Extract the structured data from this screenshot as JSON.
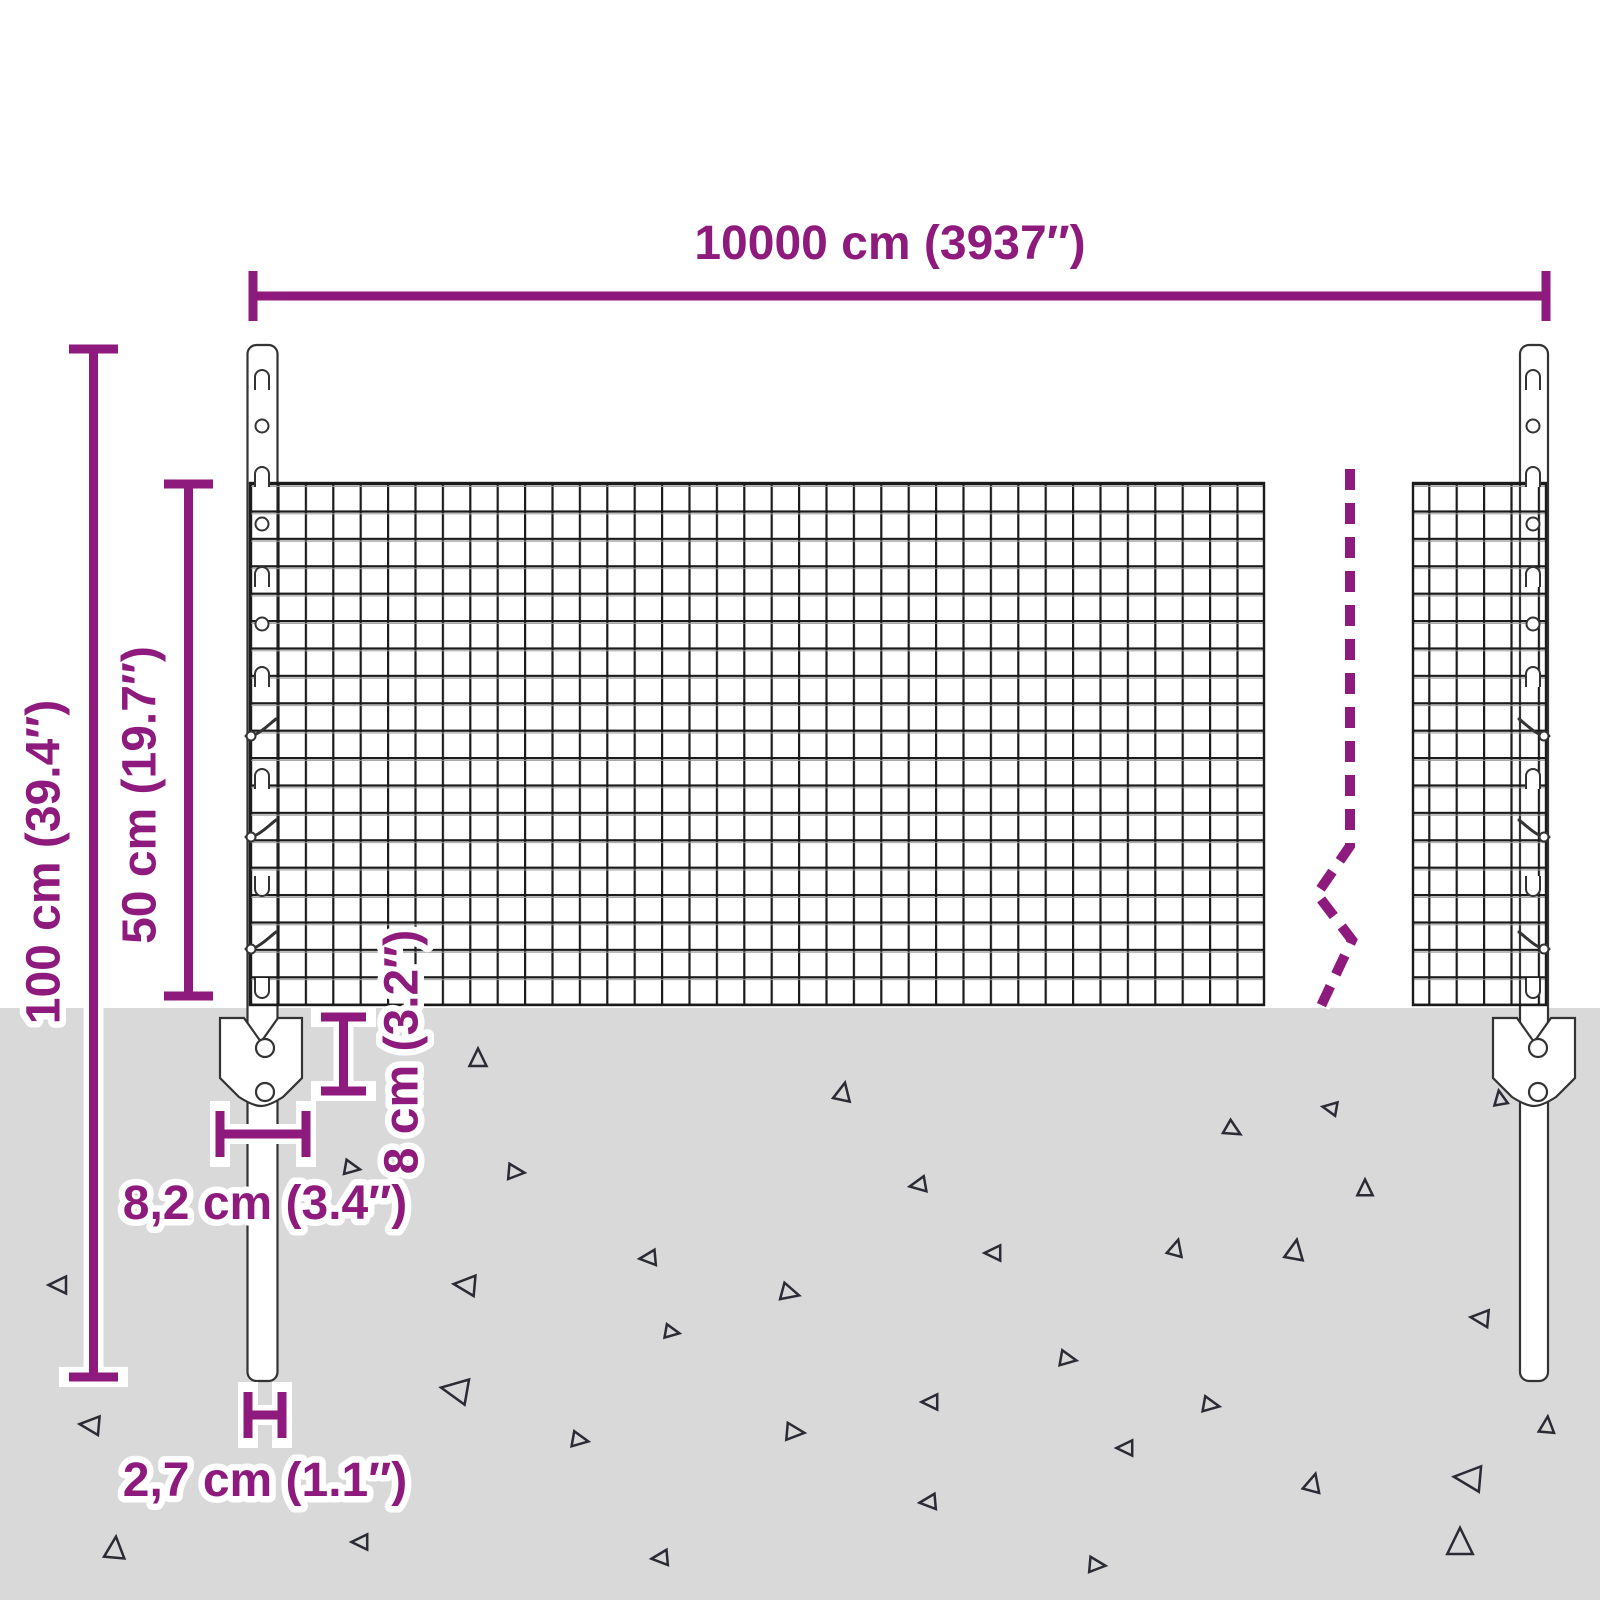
{
  "diagram": {
    "dimensions": {
      "total_width": {
        "label": "10000 cm (3937″)"
      },
      "post_height": {
        "label": "100 cm (39.4″)"
      },
      "mesh_height": {
        "label": "50 cm (19.7″)"
      },
      "anchor_depth": {
        "label": "8 cm (3.2″)"
      },
      "anchor_width": {
        "label": "8,2 cm (3.4″)"
      },
      "post_width": {
        "label": "2,7 cm (1.1″)"
      }
    },
    "colors": {
      "accent": "#8e1a7d",
      "ground": "#d9d9d9",
      "mesh_line": "#1b1b1b",
      "outline": "#333333"
    }
  }
}
